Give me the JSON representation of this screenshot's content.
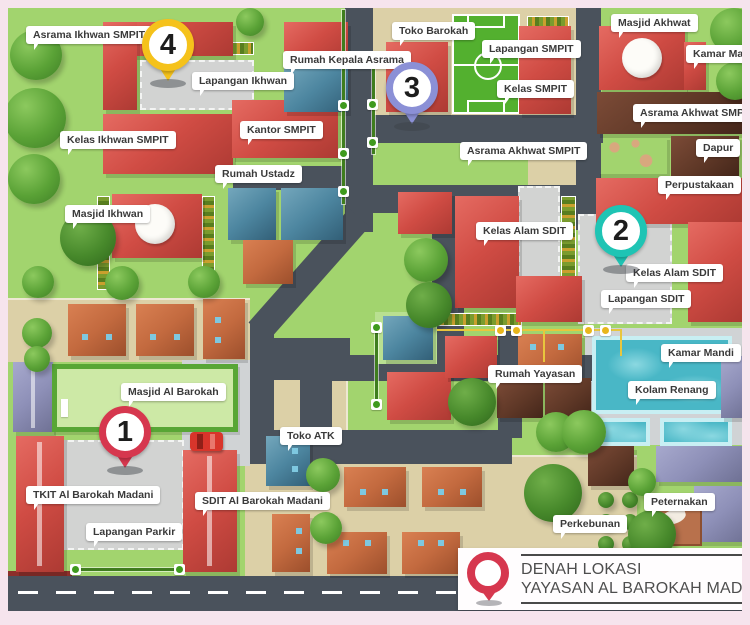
{
  "title": {
    "line1": "DENAH LOKASI",
    "line2": "YAYASAN AL BAROKAH MADANI"
  },
  "colors": {
    "grass": "#a2d46e",
    "tan_ground": "#dcd0a7",
    "road": "#4a525c",
    "pin1": "#d6374e",
    "pin2": "#1fc4b4",
    "pin3": "#8b90d6",
    "pin4": "#f5c21b",
    "title_pin": "#d6374e",
    "label_text": "#3a3a3a"
  },
  "pins": [
    {
      "number": "1",
      "color": "#d6374e",
      "x": 91,
      "y": 398
    },
    {
      "number": "2",
      "color": "#1fc4b4",
      "x": 587,
      "y": 197
    },
    {
      "number": "3",
      "color": "#8b90d6",
      "x": 378,
      "y": 54
    },
    {
      "number": "4",
      "color": "#f5c21b",
      "x": 134,
      "y": 11
    }
  ],
  "labels": [
    {
      "text": "Asrama Ikhwan SMPIT",
      "x": 18,
      "y": 18
    },
    {
      "text": "Lapangan Ikhwan",
      "x": 184,
      "y": 64
    },
    {
      "text": "Rumah Kepala Asrama",
      "x": 275,
      "y": 43
    },
    {
      "text": "Toko Barokah",
      "x": 384,
      "y": 14
    },
    {
      "text": "Lapangan SMPIT",
      "x": 474,
      "y": 32
    },
    {
      "text": "Kelas SMPIT",
      "x": 489,
      "y": 72
    },
    {
      "text": "Masjid Akhwat",
      "x": 603,
      "y": 6
    },
    {
      "text": "Kamar Mandi",
      "x": 678,
      "y": 37
    },
    {
      "text": "Asrama Akhwat SMPIT",
      "x": 625,
      "y": 96
    },
    {
      "text": "Dapur",
      "x": 688,
      "y": 131
    },
    {
      "text": "Perpustakaan",
      "x": 650,
      "y": 168
    },
    {
      "text": "Kelas Ikhwan SMPIT",
      "x": 52,
      "y": 123
    },
    {
      "text": "Kantor SMPIT",
      "x": 232,
      "y": 113
    },
    {
      "text": "Rumah Ustadz",
      "x": 207,
      "y": 157
    },
    {
      "text": "Masjid Ikhwan",
      "x": 57,
      "y": 197
    },
    {
      "text": "Asrama Akhwat SMPIT",
      "x": 452,
      "y": 134
    },
    {
      "text": "Kelas Alam SDIT",
      "x": 468,
      "y": 214
    },
    {
      "text": "Kelas Alam SDIT",
      "x": 618,
      "y": 256
    },
    {
      "text": "Lapangan SDIT",
      "x": 593,
      "y": 282
    },
    {
      "text": "Masjid Al Barokah",
      "x": 113,
      "y": 375
    },
    {
      "text": "Rumah Yayasan",
      "x": 480,
      "y": 357
    },
    {
      "text": "Kamar Mandi",
      "x": 653,
      "y": 336
    },
    {
      "text": "Kolam Renang",
      "x": 620,
      "y": 373
    },
    {
      "text": "Toko ATK",
      "x": 272,
      "y": 419
    },
    {
      "text": "TKIT Al Barokah Madani",
      "x": 18,
      "y": 478
    },
    {
      "text": "SDIT Al Barokah Madani",
      "x": 187,
      "y": 484
    },
    {
      "text": "Lapangan Parkir",
      "x": 78,
      "y": 515
    },
    {
      "text": "Perkebunan",
      "x": 545,
      "y": 507
    },
    {
      "text": "Peternakan",
      "x": 636,
      "y": 485
    }
  ]
}
